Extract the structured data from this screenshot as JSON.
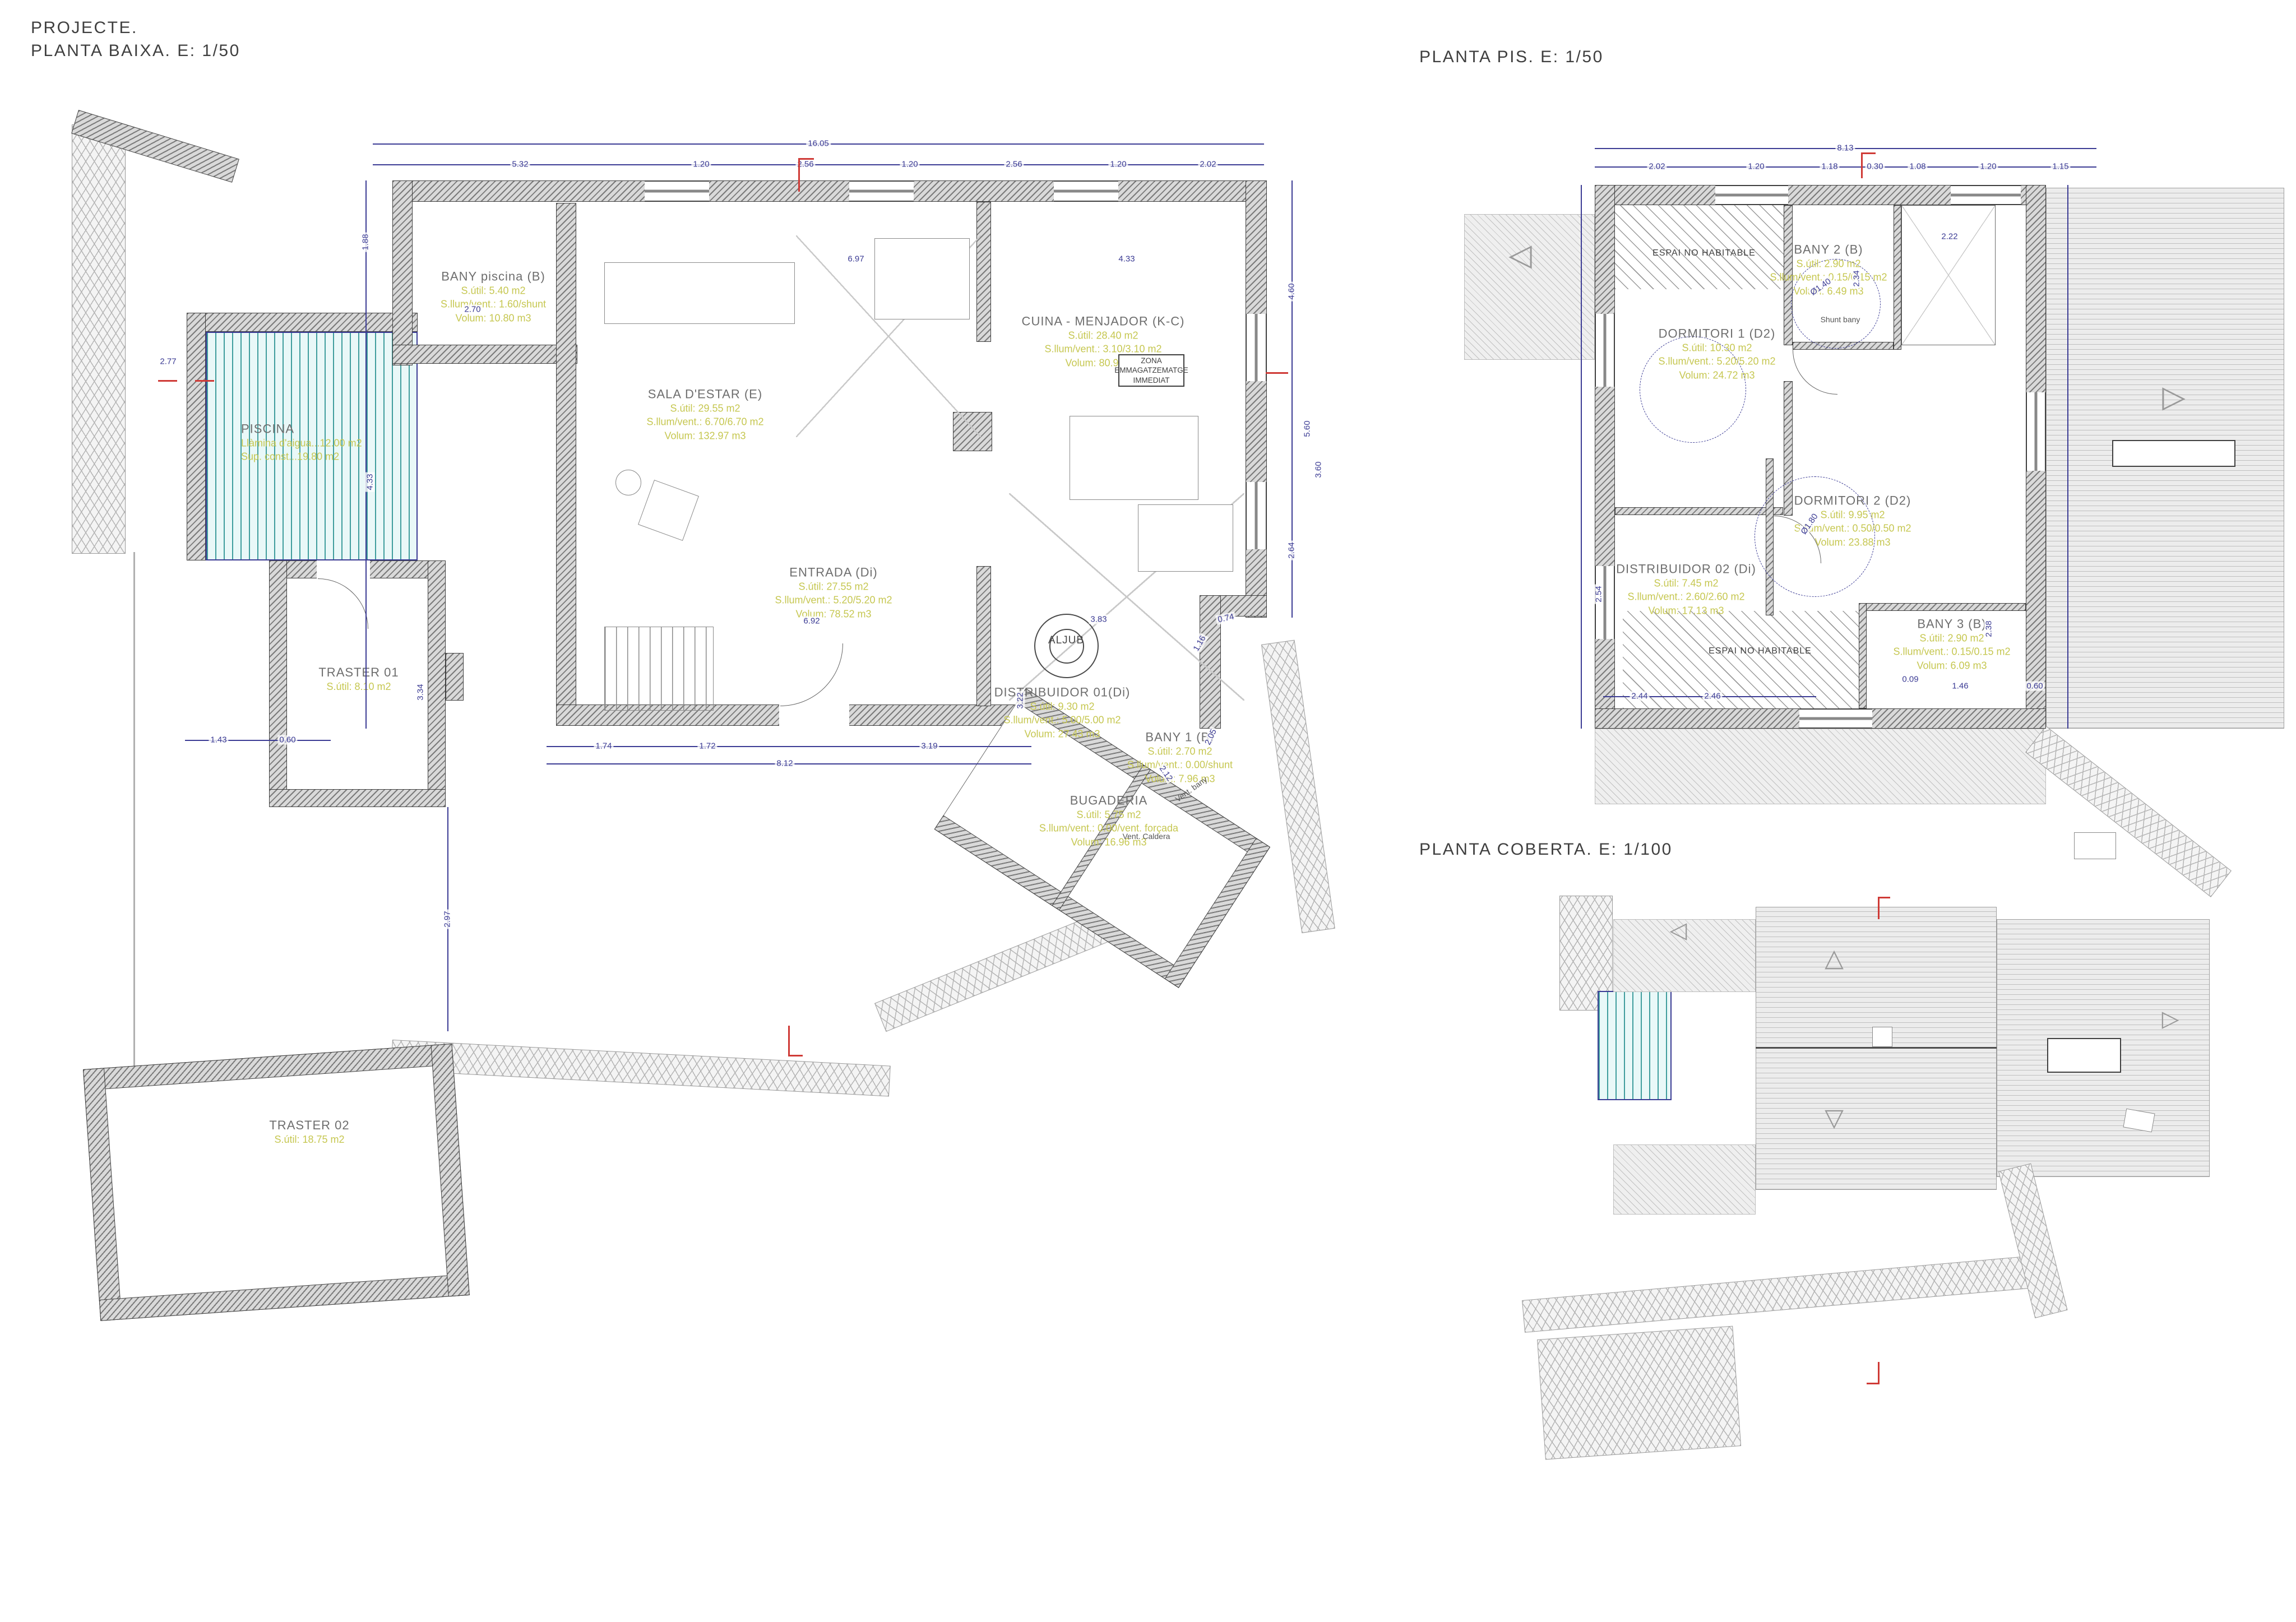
{
  "colors": {
    "dimension": "#3b3b94",
    "room_name": "#6e6e6e",
    "room_metrics": "#c6c751",
    "wall_gray": "#7a7a7a",
    "pool_teal": "#3f9d9d",
    "section_red": "#cf3a36"
  },
  "titles": {
    "project": "PROJECTE.",
    "baixa": "PLANTA BAIXA. E: 1/50",
    "pis": "PLANTA PIS. E: 1/50",
    "coberta": "PLANTA COBERTA. E: 1/100"
  },
  "baixa": {
    "rooms": [
      {
        "name": "BANY piscina (B)",
        "l1": "S.útil: 5.40 m2",
        "l2": "S.llum/vent.: 1.60/shunt",
        "l3": "Volum: 10.80 m3"
      },
      {
        "name": "SALA D'ESTAR (E)",
        "l1": "S.útil: 29.55 m2",
        "l2": "S.llum/vent.: 6.70/6.70 m2",
        "l3": "Volum: 132.97 m3"
      },
      {
        "name": "CUINA - MENJADOR (K-C)",
        "l1": "S.útil: 28.40 m2",
        "l2": "S.llum/vent.: 3.10/3.10 m2",
        "l3": "Volum: 80.94 m3"
      },
      {
        "name": "ENTRADA (Di)",
        "l1": "S.útil: 27.55 m2",
        "l2": "S.llum/vent.: 5.20/5.20 m2",
        "l3": "Volum: 78.52 m3"
      },
      {
        "name": "DISTRIBUIDOR 01(Di)",
        "l1": "S.útil: 9.30 m2",
        "l2": "S.llum/vent.: 5.00/5.00 m2",
        "l3": "Volum: 27.43 m3"
      },
      {
        "name": "BANY 1 (B)",
        "l1": "S.útil: 2.70 m2",
        "l2": "S.llum/vent.: 0.00/shunt",
        "l3": "Volum: 7.96 m3"
      },
      {
        "name": "BUGADERIA",
        "l1": "S.útil: 5.75 m2",
        "l2": "S.llum/vent.: 0.00/vent. forçada",
        "l3": "Volum: 16.96 m3"
      },
      {
        "name": "PISCINA",
        "l1": "Llàmina d'aigua...12.00 m2",
        "l2": "Sup. const...19.80 m2"
      },
      {
        "name": "TRASTER 01",
        "l1": "S.útil: 8.10 m2"
      },
      {
        "name": "TRASTER 02",
        "l1": "S.útil: 18.75 m2"
      }
    ],
    "annotations": {
      "aljub": "ALJUB",
      "zona_l1": "ZONA",
      "zona_l2": "EMMAGATZEMATGE",
      "zona_l3": "IMMEDIAT",
      "vent_caldera": "Vent. Caldera",
      "vent_bany": "Vent. bany"
    }
  },
  "pis": {
    "rooms": [
      {
        "name": "DORMITORI 1 (D2)",
        "l1": "S.útil: 10.30 m2",
        "l2": "S.llum/vent.: 5.20/5.20 m2",
        "l3": "Volum: 24.72 m3"
      },
      {
        "name": "BANY 2 (B)",
        "l1": "S.útil: 2.90 m2",
        "l2": "S.llum/vent.: 0.15/0.15 m2",
        "l3": "Volum: 6.49 m3"
      },
      {
        "name": "DORMITORI 2 (D2)",
        "l1": "S.útil: 9.95 m2",
        "l2": "S.llum/vent.: 0.50/0.50 m2",
        "l3": "Volum: 23.88 m3"
      },
      {
        "name": "DISTRIBUIDOR 02 (Di)",
        "l1": "S.útil: 7.45 m2",
        "l2": "S.llum/vent.: 2.60/2.60 m2",
        "l3": "Volum: 17.13 m3"
      },
      {
        "name": "BANY 3 (B)",
        "l1": "S.útil: 2.90 m2",
        "l2": "S.llum/vent.: 0.15/0.15 m2",
        "l3": "Volum: 6.09 m3"
      }
    ],
    "annotations": {
      "enh": "ESPAI NO HABITABLE",
      "shunt": "Shunt bany"
    }
  },
  "symbols": {
    "tri_up": "△",
    "tri_down": "▽",
    "tri_left": "◁",
    "tri_right": "▷"
  },
  "dims": {
    "all": [
      "16.05",
      "5.32",
      "1.20",
      "2.56",
      "1.20",
      "2.56",
      "1.20",
      "2.02",
      "2.70",
      "2.77",
      "4.33",
      "3.34",
      "6.92",
      "6.97",
      "4.33",
      "3.83",
      "1.16",
      "0.74",
      "2.05",
      "3.22",
      "2.12",
      "1.74",
      "1.72",
      "3.19",
      "8.12",
      "1.43",
      "0.60",
      "2.97",
      "1.88",
      "4.60",
      "5.60",
      "3.60",
      "2.64",
      "8.13",
      "2.02",
      "1.20",
      "1.18",
      "0.30",
      "1.08",
      "1.20",
      "1.15",
      "2.54",
      "2.46",
      "2.34",
      "Ø1.40",
      "Ø1.80",
      "2.22",
      "2.38",
      "1.46",
      "0.60",
      "0.09",
      "2.44"
    ]
  }
}
